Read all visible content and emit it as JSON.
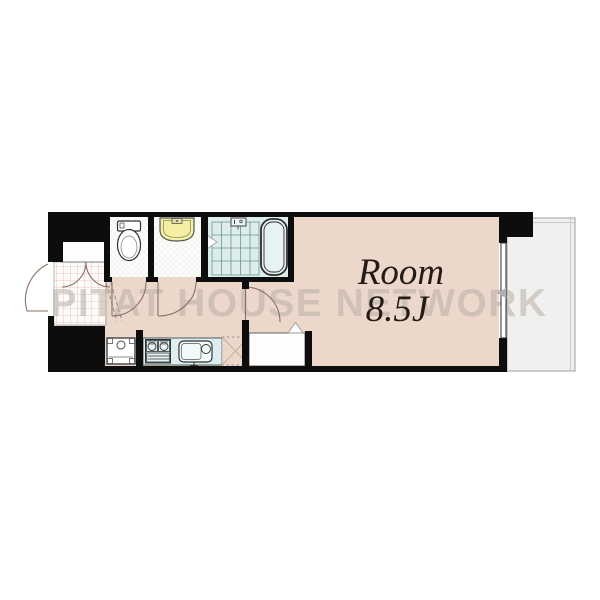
{
  "floorplan": {
    "room_label": "Room",
    "room_size": "8.5J",
    "watermark": "PITAT HOUSE NETWORK",
    "areas": [
      "entrance",
      "hallway",
      "toilet-room",
      "washroom",
      "bathroom",
      "kitchen",
      "main-room",
      "closet",
      "balcony"
    ],
    "fixtures": [
      "toilet",
      "washbasin",
      "bathtub",
      "shower-floor-grid",
      "gas-stove",
      "kitchen-sink",
      "washing-machine-space",
      "refrigerator-space",
      "entrance-tile",
      "shoe-closet"
    ],
    "colors": {
      "wall": "#0d0d0d",
      "room_floor": "#ecd8cb",
      "wet_area": "#dcedec",
      "kitchen_counter": "#ddeef0",
      "basin": "#f4efa3",
      "balcony": "#f0f0ee",
      "tile_grid": "#e3b8b0",
      "watermark": "#b9afa6",
      "door_arc": "#8a7165",
      "label_text": "#241b15"
    }
  }
}
